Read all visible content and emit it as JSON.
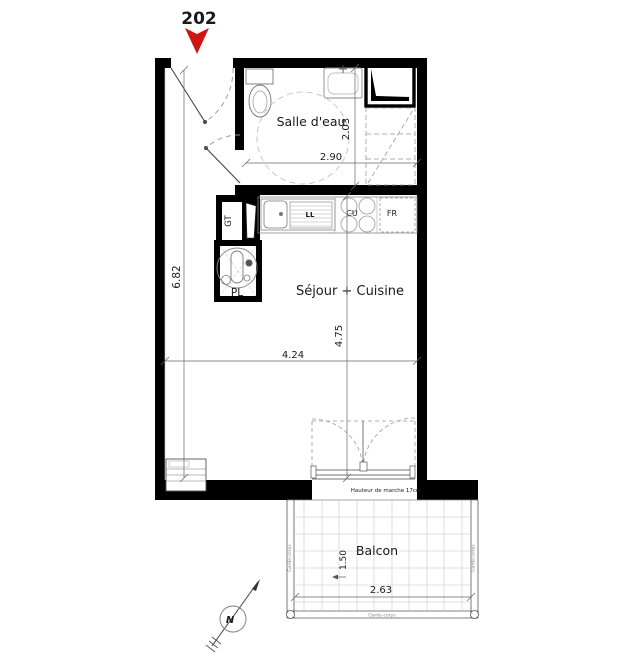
{
  "plan": {
    "unit_number": "202",
    "rooms": {
      "bathroom": "Salle d'eau",
      "living_kitchen": "Séjour + Cuisine",
      "balcony": "Balcon"
    },
    "fixtures": {
      "technical_duct": "GT",
      "closet": "PL",
      "washing_machine": "LL",
      "cooktop": "CU",
      "fridge": "FR"
    },
    "dimensions": {
      "bathroom_width": "2.90",
      "bathroom_depth": "2.03",
      "apartment_depth": "6.82",
      "living_width": "4.24",
      "living_depth": "4.75",
      "balcony_width": "2.63",
      "balcony_depth": "1.50"
    },
    "annotations": {
      "threshold_note": "Hauteur de marche 17cm",
      "railing": "Garde-corps",
      "north": "N"
    },
    "colors": {
      "wall": "#000000",
      "entry_marker": "#d01515",
      "dimension_line": "#555555",
      "light_line": "#9a9a9a"
    }
  }
}
